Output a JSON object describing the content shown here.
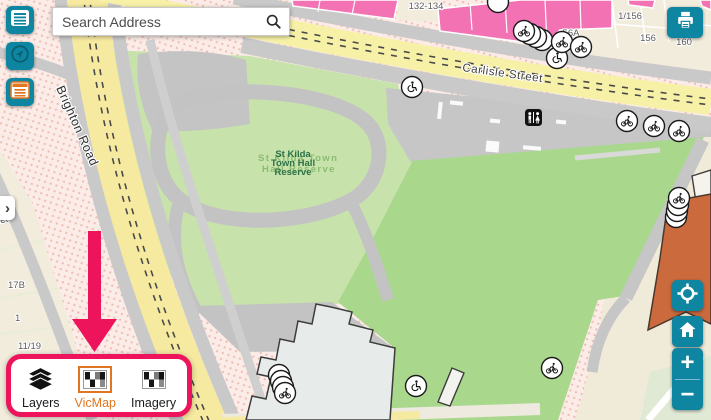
{
  "search": {
    "placeholder": "Search Address"
  },
  "toolbar": {
    "buttons": [
      "map-legend",
      "compass",
      "layer-list"
    ],
    "print": "print-map"
  },
  "nav": {
    "zoom_in": "+",
    "zoom_out": "−",
    "expand_chevron": "›"
  },
  "basemap_panel": {
    "items": [
      {
        "label": "Layers",
        "icon": "layers-stack",
        "selected": false
      },
      {
        "label": "VicMap",
        "icon": "checkerboard",
        "selected": true
      },
      {
        "label": "Imagery",
        "icon": "checkerboard",
        "selected": false
      }
    ]
  },
  "map_labels": {
    "streets": {
      "carlisle": "Carlisle Street",
      "brighton": "Brighton Road",
      "partial": "Street"
    },
    "park_front": [
      "St Kilda",
      "Town Hall",
      "Reserve"
    ],
    "park_back": [
      "St Kilda Town",
      "Hall Reserve"
    ],
    "parcels": [
      "132-134",
      "1/156",
      "56A",
      "156",
      "160",
      "17B",
      "1",
      "11/19"
    ]
  },
  "map_markers": [
    "wheelchair-access",
    "bicycle-parking",
    "public-toilets"
  ],
  "colors": {
    "teal": "#0e86a1",
    "magenta": "#ED145B",
    "orange": "#e0761f",
    "park_green": "#c7e3ab",
    "lawn_green": "#a9d88d",
    "building_pink": "#f272b4",
    "road_yellow": "#f7f1a8",
    "road_gray": "#c9c9c9",
    "town_hall_fill": "#e7ebe9",
    "orange_building": "#cb6a3d"
  }
}
